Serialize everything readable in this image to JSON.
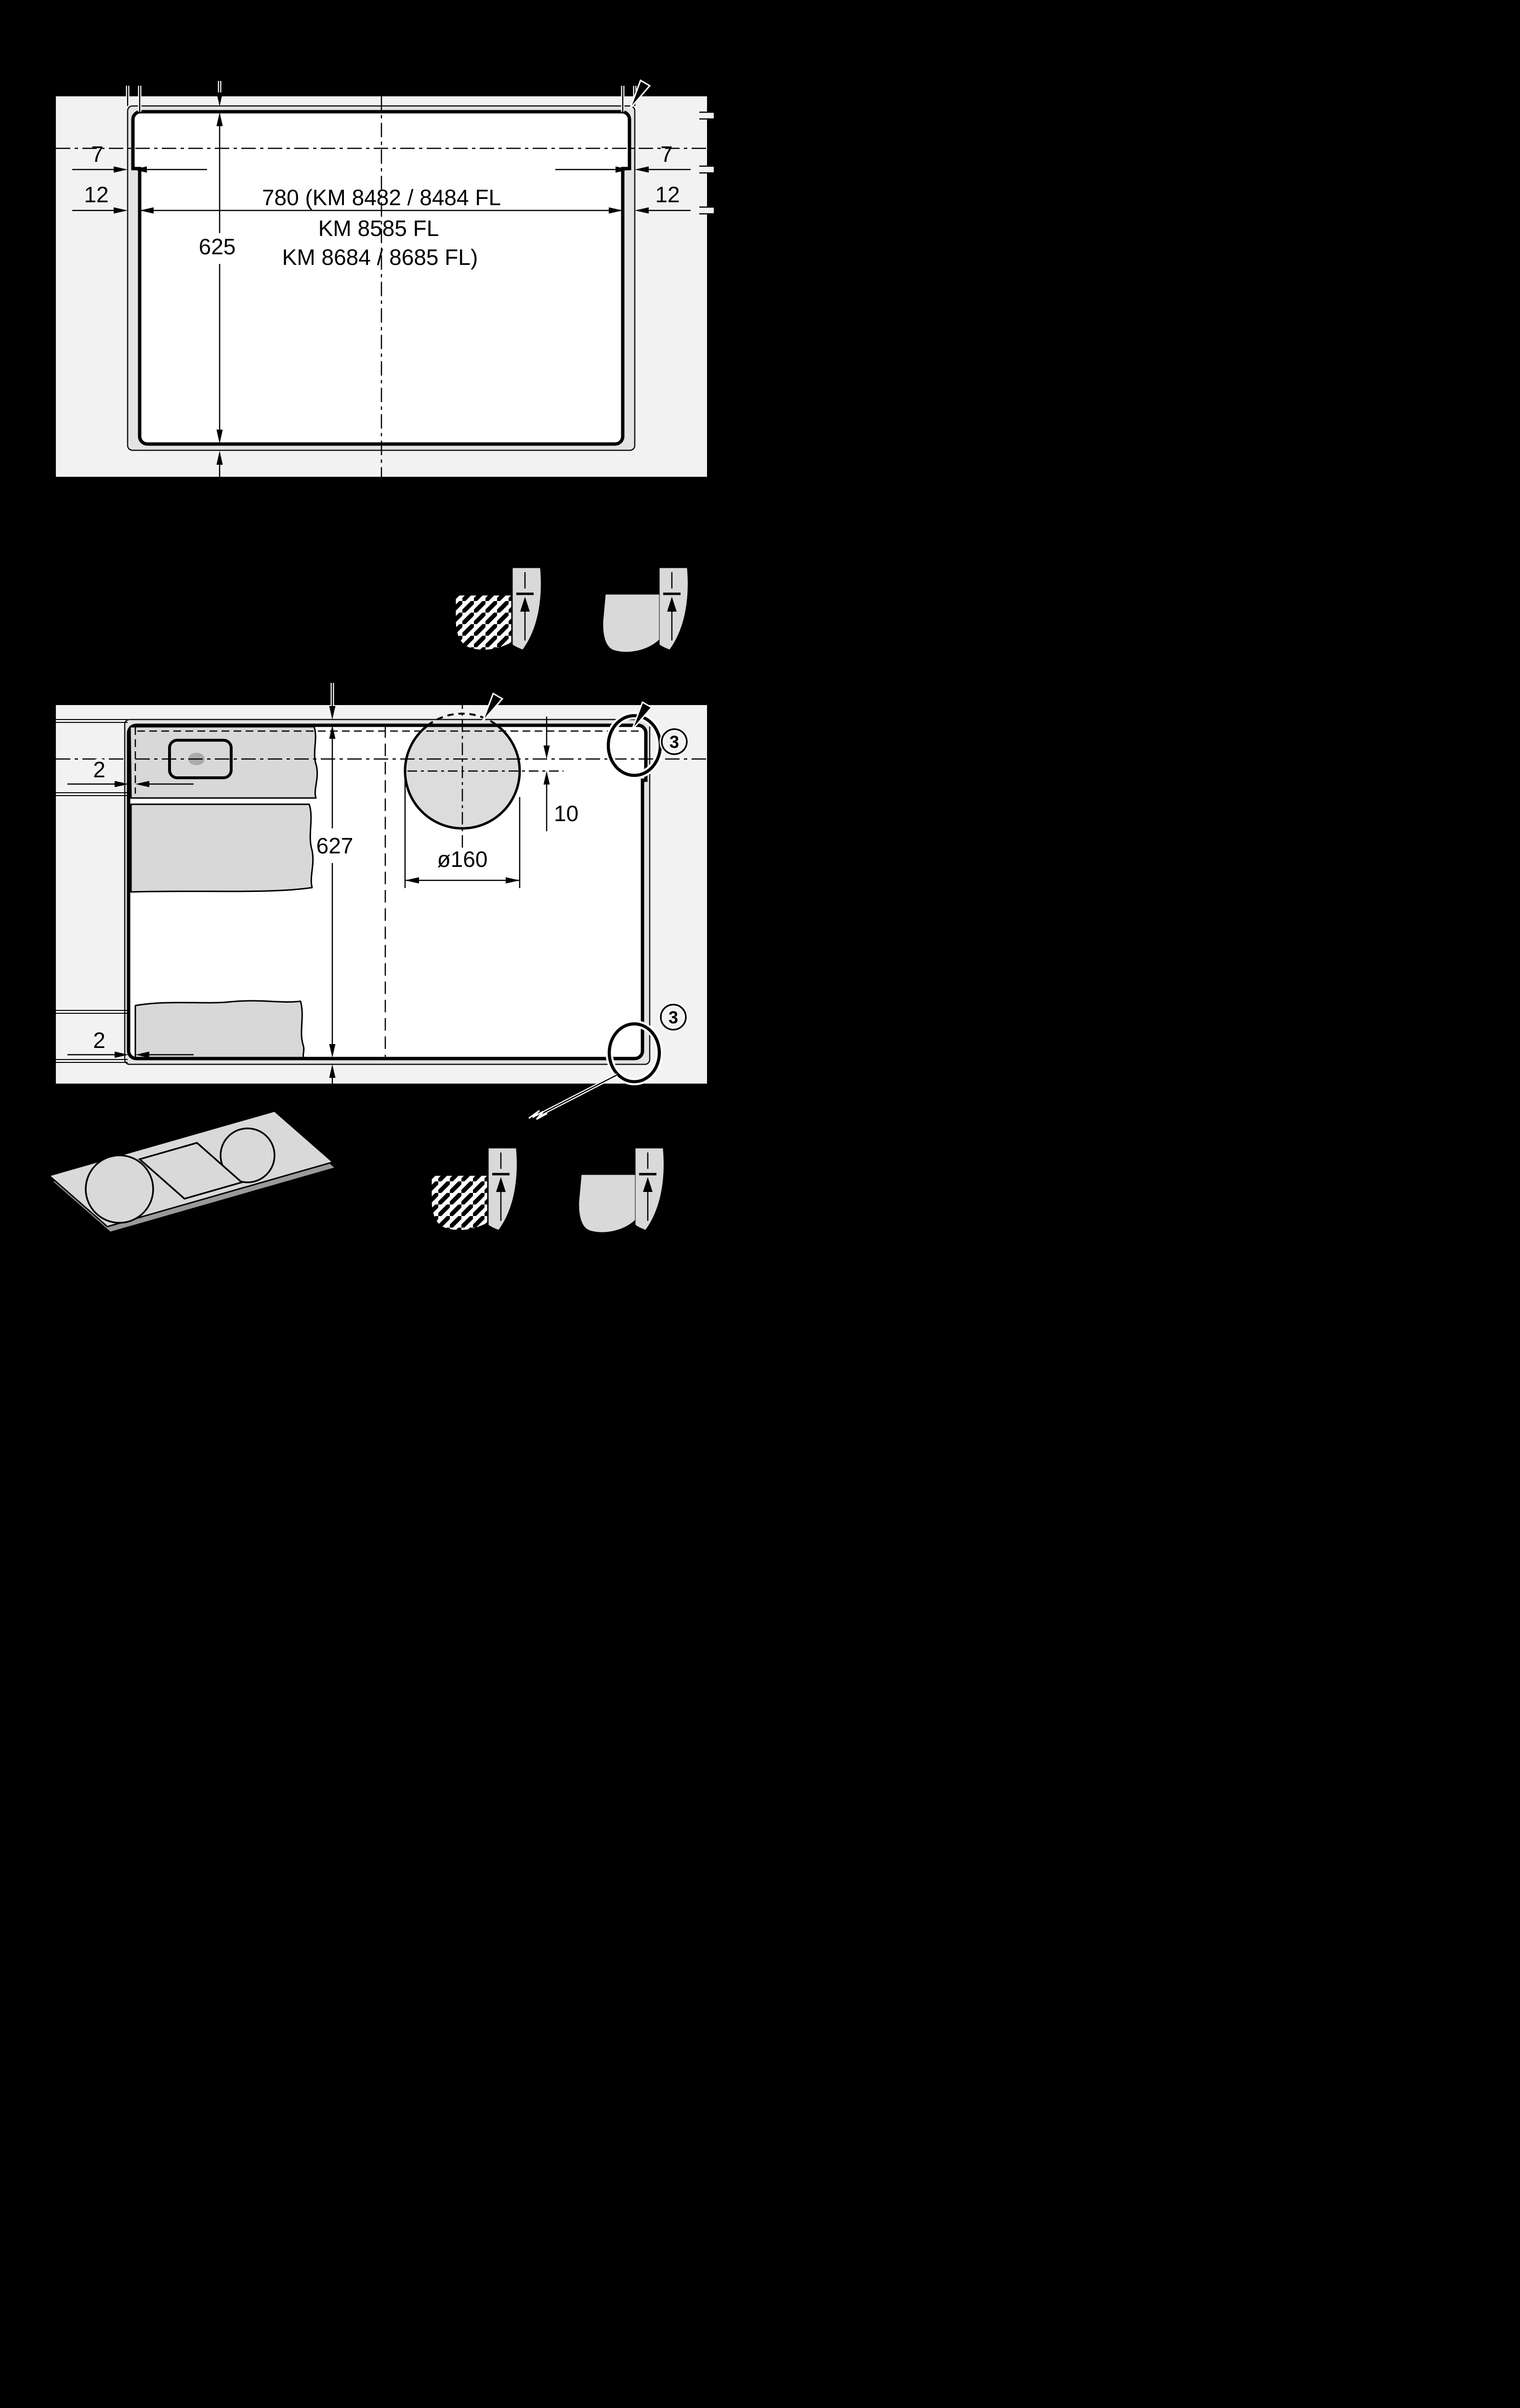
{
  "page": {
    "background_color": "#000000",
    "panel_color": "#f2f2f2",
    "band_color": "#e3e3e3",
    "fragment_color": "#d8d8d8",
    "line_color": "#000000"
  },
  "top_diagram": {
    "width_dimension_line1": "780 (KM 8482 / 8484 FL",
    "width_dimension_line2": "KM 8585 FL",
    "width_dimension_line3": "KM 8684 / 8685 FL)",
    "depth_dimension": "625",
    "edge_clearance_left": "7",
    "edge_clearance_right": "7",
    "ledge_width_left": "12",
    "ledge_width_right": "12"
  },
  "bottom_diagram": {
    "depth_dimension": "627",
    "glass_clearance_top_left": "2",
    "glass_clearance_bottom_left": "2",
    "hole_diameter_label": "ø160",
    "hole_offset_label": "10",
    "corner_detail_marker_top": "3",
    "corner_detail_marker_bottom": "3"
  },
  "icons": {
    "corner_section_stone": "hatched-quarter-section-icon",
    "corner_section_solid": "plain-quarter-section-icon",
    "corner_radius_pointer": "thick-arrow-icon",
    "sealant_note": "scribble-icon",
    "cooktop_isometric": "cooktop-product-icon"
  }
}
